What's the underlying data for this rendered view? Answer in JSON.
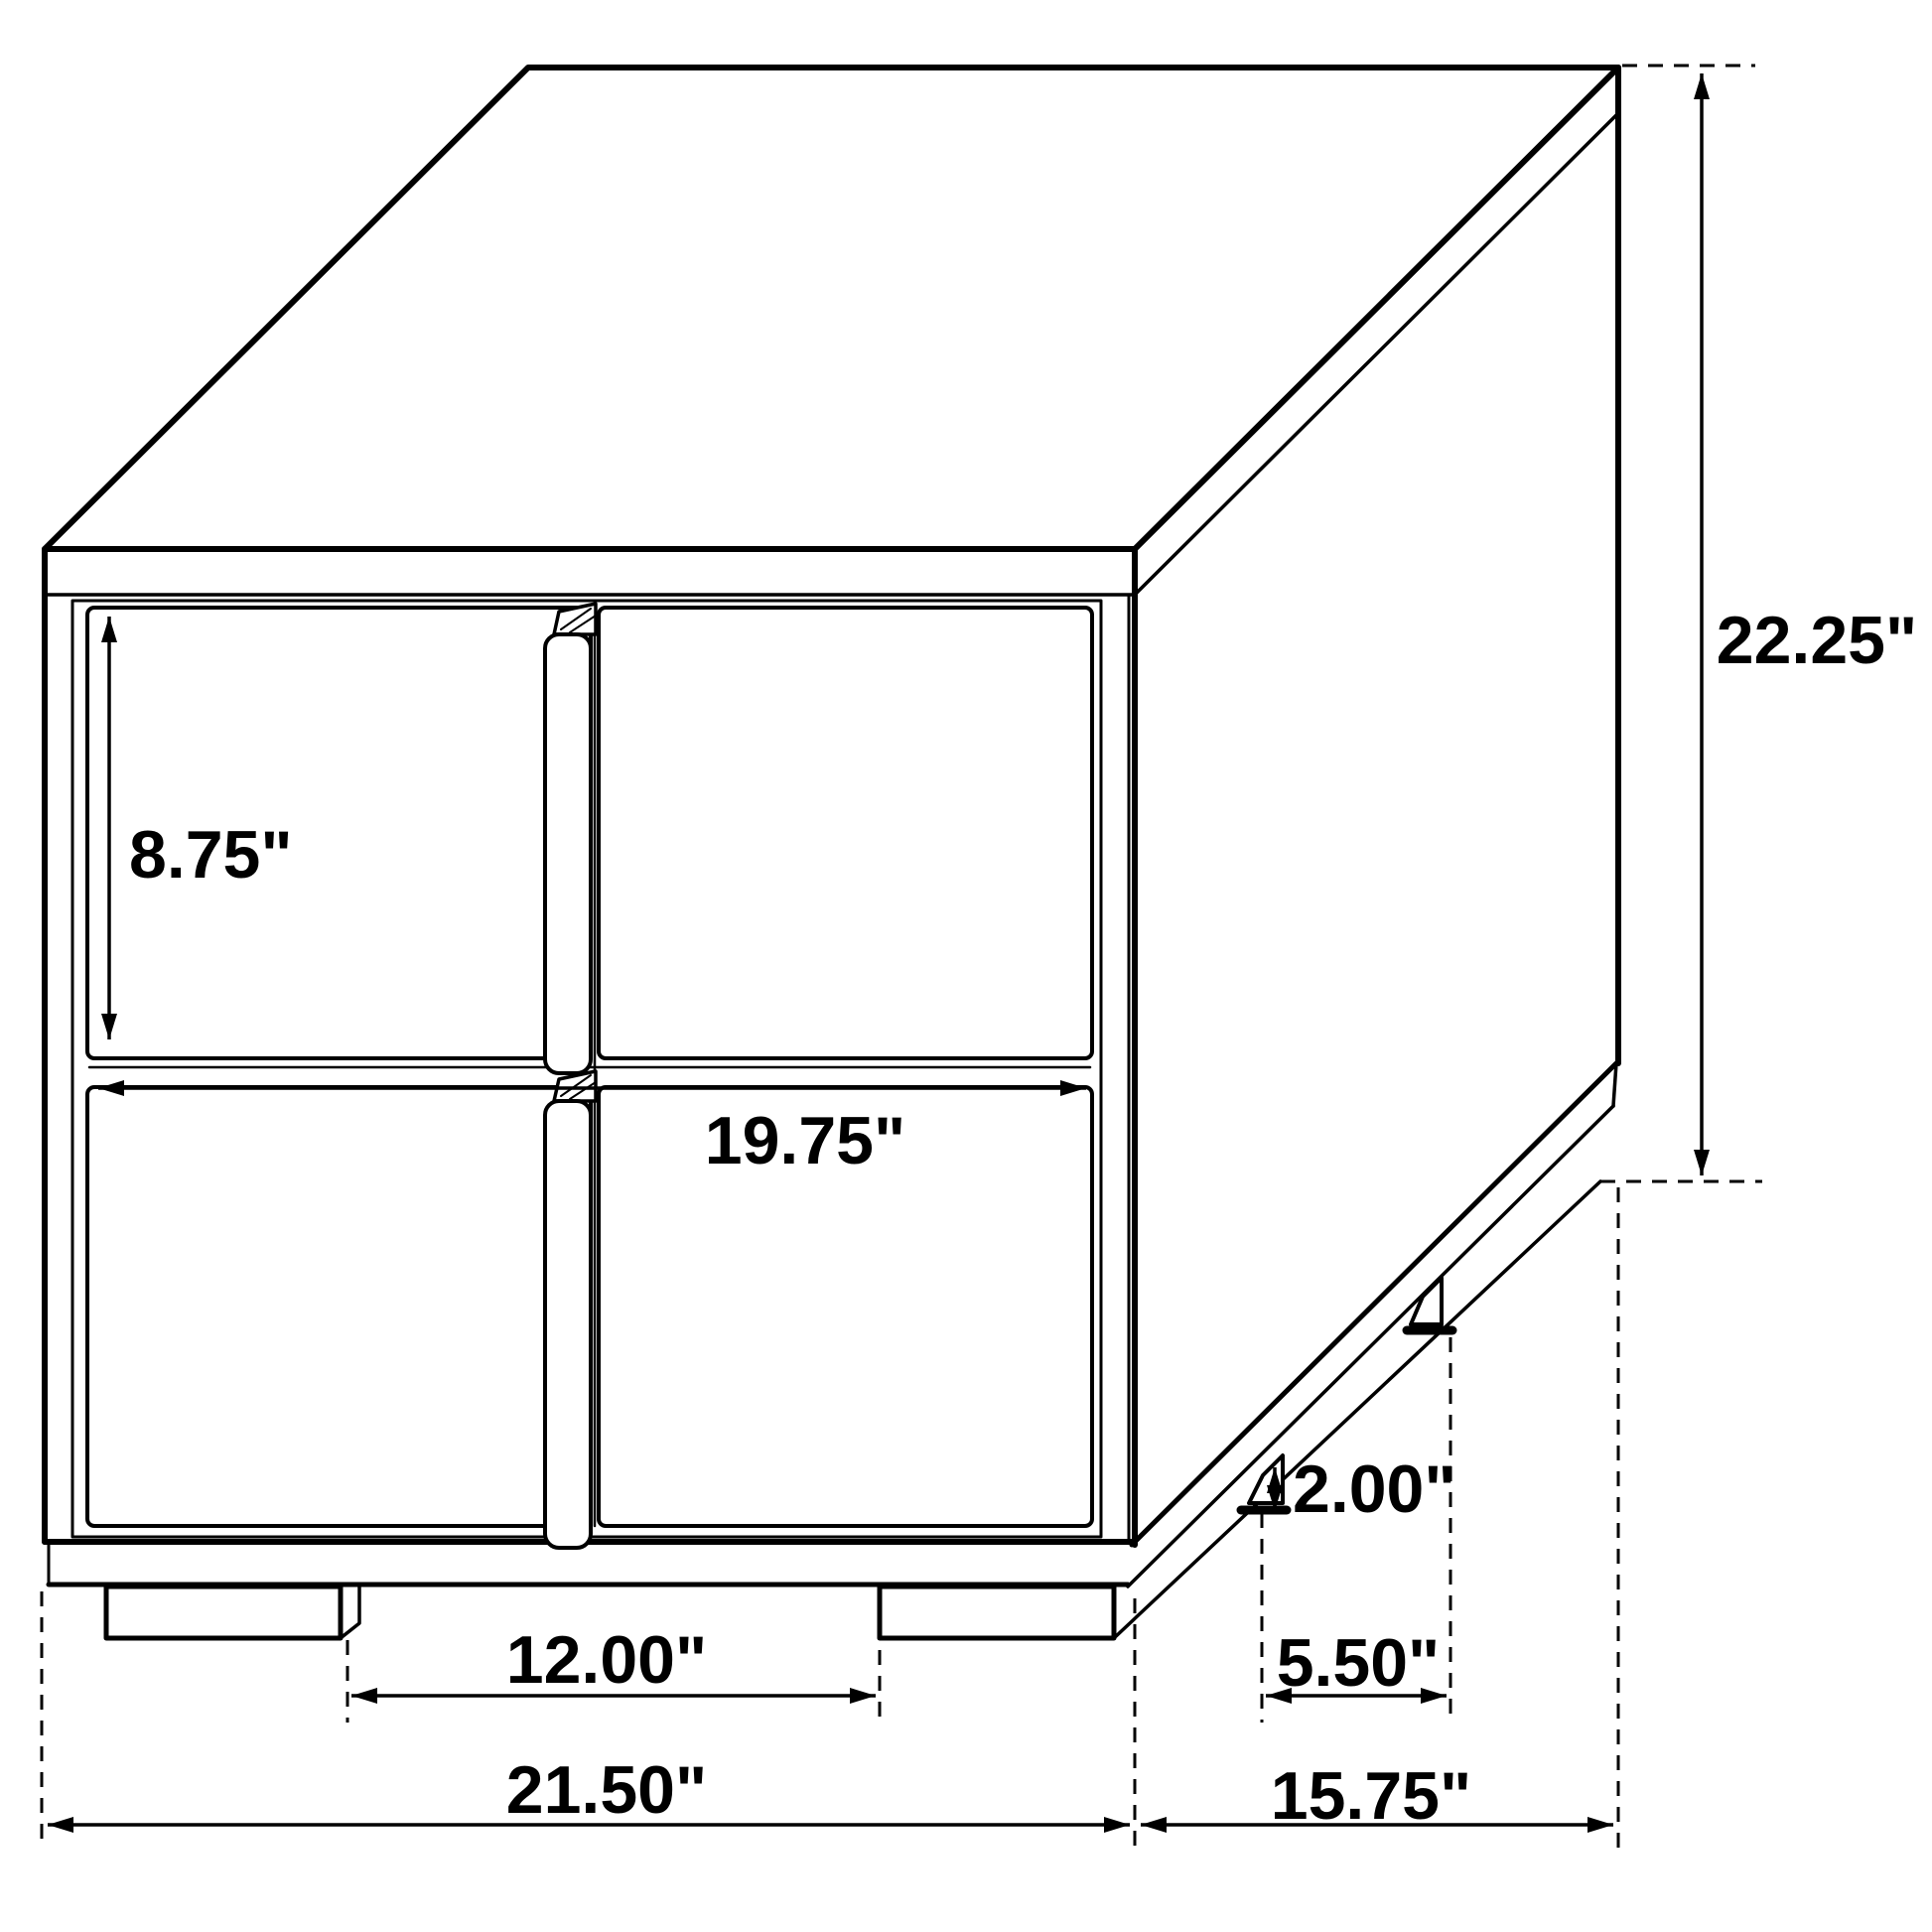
{
  "diagram": {
    "type": "furniture-dimension-drawing",
    "subject": "two-drawer nightstand isometric view",
    "line_color": "#000000",
    "background_color": "#ffffff",
    "labels": {
      "drawer_height": "8.75\"",
      "drawer_width": "19.75\"",
      "overall_height": "22.25\"",
      "leg_height": "2.00\"",
      "front_leg_spacing": "12.00\"",
      "side_leg_spacing": "5.50\"",
      "overall_width": "21.50\"",
      "overall_depth": "15.75\""
    }
  }
}
